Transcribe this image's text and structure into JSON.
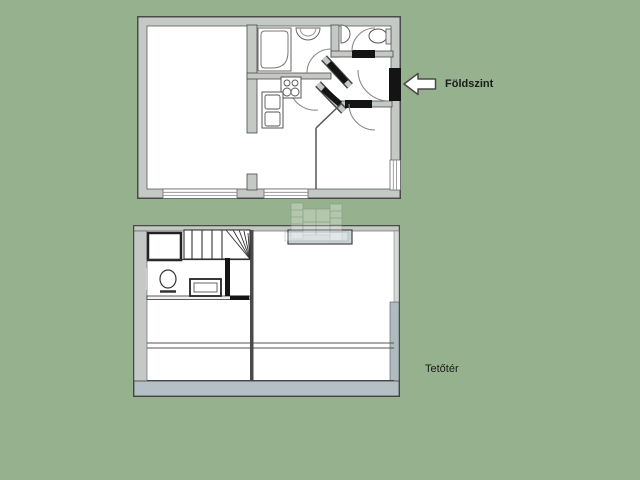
{
  "sheet": {
    "type": "real-estate floor plan sheet",
    "background_color": "#95b18d"
  },
  "labels": {
    "ground_floor": "Földszint",
    "attic": "Tetőtér"
  },
  "arrow": {
    "direction": "left",
    "fill": "#ffffff",
    "outline": "#4a4a4a"
  },
  "colors": {
    "wall_gray": "#c5c9c5",
    "wall_outline": "#4a4a4a",
    "door_black": "#141414",
    "eaves_gray": "#b4c0c5",
    "skylight_gray": "#ccd5d7",
    "floor_white": "#ffffff",
    "text": "#1b1b1b"
  }
}
